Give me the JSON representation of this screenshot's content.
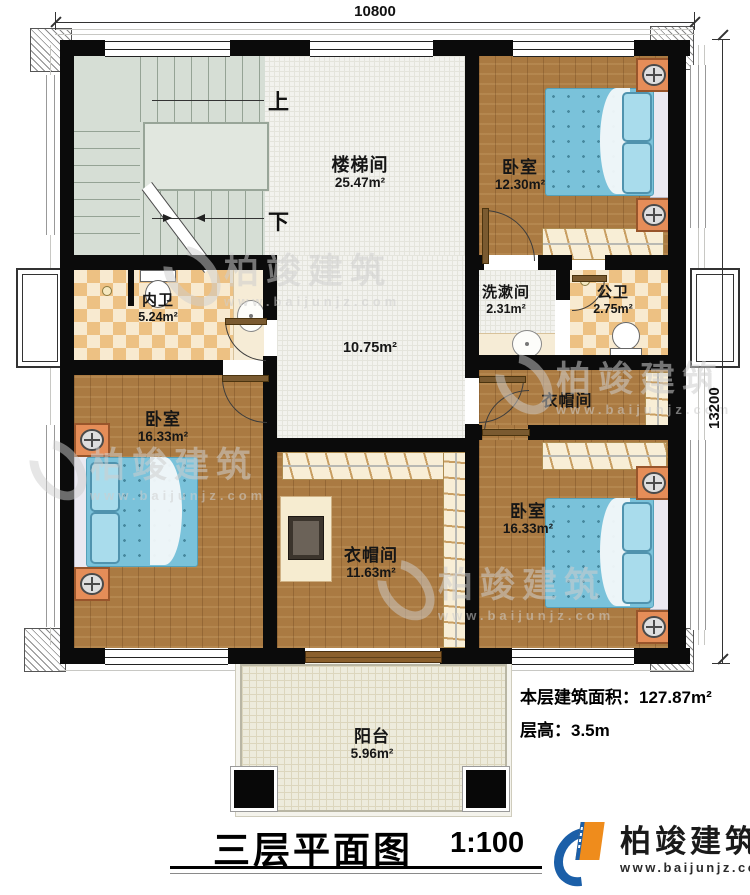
{
  "dimensions": {
    "width": "10800",
    "height": "13200"
  },
  "stairwell": {
    "name": "楼梯间",
    "area": "25.47m²",
    "up_label": "上",
    "down_label": "下"
  },
  "hall": {
    "area": "10.75m²"
  },
  "rooms": {
    "bedroom_top_right": {
      "name": "卧室",
      "area": "12.30m²"
    },
    "washroom": {
      "name": "洗漱间",
      "area": "2.31m²"
    },
    "public_bathroom": {
      "name": "公卫",
      "area": "2.75m²"
    },
    "private_bathroom": {
      "name": "内卫",
      "area": "5.24m²"
    },
    "bedroom_left": {
      "name": "卧室",
      "area": "16.33m²"
    },
    "cloakroom_right": {
      "name": "衣帽间"
    },
    "cloakroom_center": {
      "name": "衣帽间",
      "area": "11.63m²"
    },
    "bedroom_bottom_right": {
      "name": "卧室",
      "area": "16.33m²"
    },
    "balcony": {
      "name": "阳台",
      "area": "5.96m²"
    }
  },
  "footer": {
    "floor_area_label": "本层建筑面积：",
    "floor_area_value": "127.87m²",
    "floor_height_label": "层高：",
    "floor_height_value": "3.5m",
    "title": "三层平面图",
    "scale": "1:100"
  },
  "brand": {
    "name": "柏竣建筑",
    "website": "www.baijunjz.com"
  },
  "watermark": {
    "name": "柏竣建筑",
    "website": "www.baijunjz.com"
  },
  "colors": {
    "wall": "#0b0b0b",
    "wood_floor": "#aa7a42",
    "hall_tile": "#f2f2ee",
    "bath_tile_dark": "#edc183",
    "bath_tile_light": "#f8ead0",
    "stair_floor": "#d6ded5",
    "balcony_floor": "#edebdc",
    "bed_blue": "#7ac2da",
    "brand_blue": "#1b5fa8",
    "brand_orange": "#ef8c1c"
  }
}
